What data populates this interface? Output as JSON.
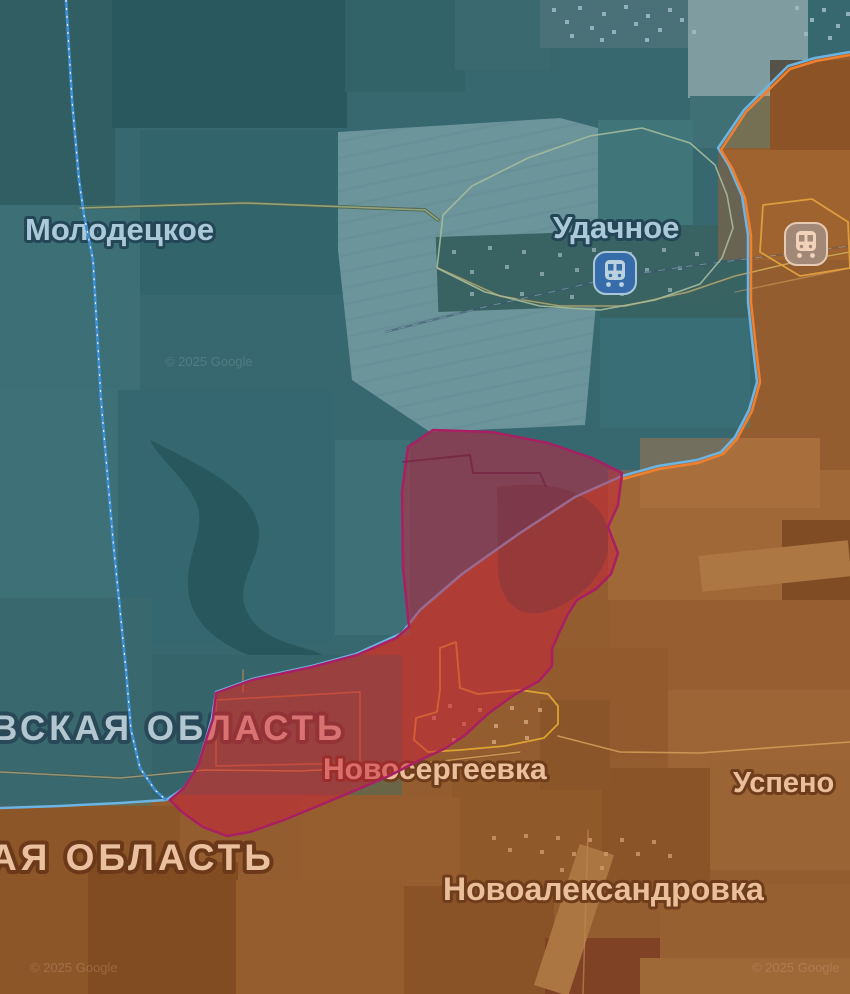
{
  "map": {
    "labels": {
      "molodetske": "Молодецкое",
      "udachne": "Удачное",
      "region_upper": "ВСКАЯ ОБЛАСТЬ",
      "region_lower": "АЯ ОБЛАСТЬ",
      "novoserhiivka": "Новосергеевка",
      "uspeno": "Успено",
      "novooleksandrivka": "Новоалександровка"
    },
    "attribution": "© 2025 Google",
    "zones": [
      {
        "name": "ukrainian-controlled",
        "fill": "#1f6a91",
        "border": "#6cb4e4"
      },
      {
        "name": "occupied-territory",
        "fill": "#d2691e",
        "border": "#ef8030"
      },
      {
        "name": "recent-advance",
        "fill": "#c91e3a",
        "border": "#a81f63"
      }
    ],
    "boundary": {
      "name": "oblast-boundary",
      "color": "#3f8fd4"
    },
    "settlement_outline_color": "#e8c23a"
  }
}
